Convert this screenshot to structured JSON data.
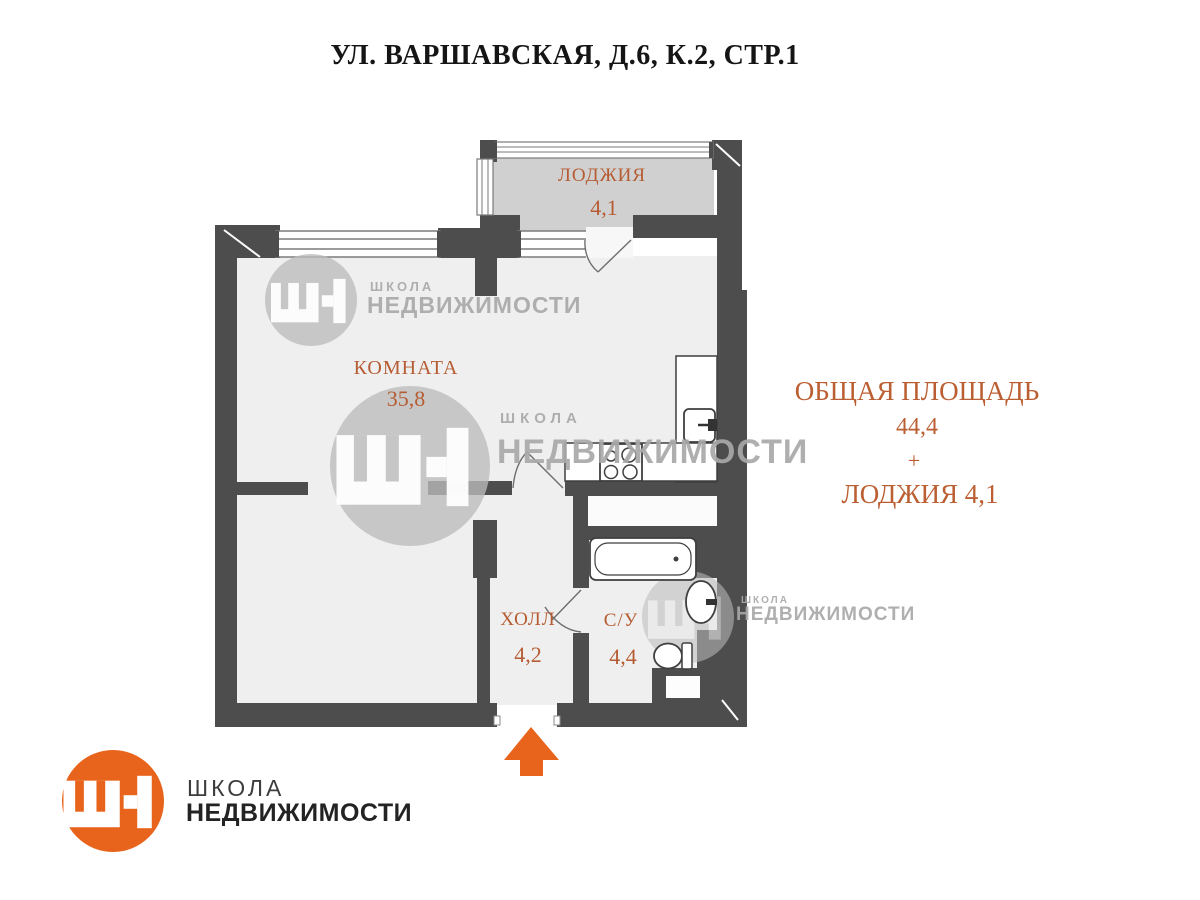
{
  "title": "УЛ. ВАРШАВСКАЯ, Д.6, К.2, СТР.1",
  "rooms": {
    "loggia": {
      "name": "ЛОДЖИЯ",
      "area": "4,1"
    },
    "room": {
      "name": "КОМНАТА",
      "area": "35,8"
    },
    "hall": {
      "name": "ХОЛЛ",
      "area": "4,2"
    },
    "bathroom": {
      "name": "С/У",
      "area": "4,4"
    }
  },
  "summary": {
    "title": "ОБЩАЯ ПЛОЩАДЬ",
    "total": "44,4",
    "plus": "+",
    "loggia_line": "ЛОДЖИЯ 4,1"
  },
  "brand": {
    "school": "ШКОЛА",
    "realty": "НЕДВИЖИМОСТИ"
  },
  "colors": {
    "wall": "#4d4d4d",
    "room_fill": "#efefef",
    "loggia_fill": "#d0d0d0",
    "accent_orange": "#e8641c",
    "label_orange": "#b65c33",
    "watermark_gray": "#bbbbbb",
    "watermark_text": "#a9a9a9"
  }
}
